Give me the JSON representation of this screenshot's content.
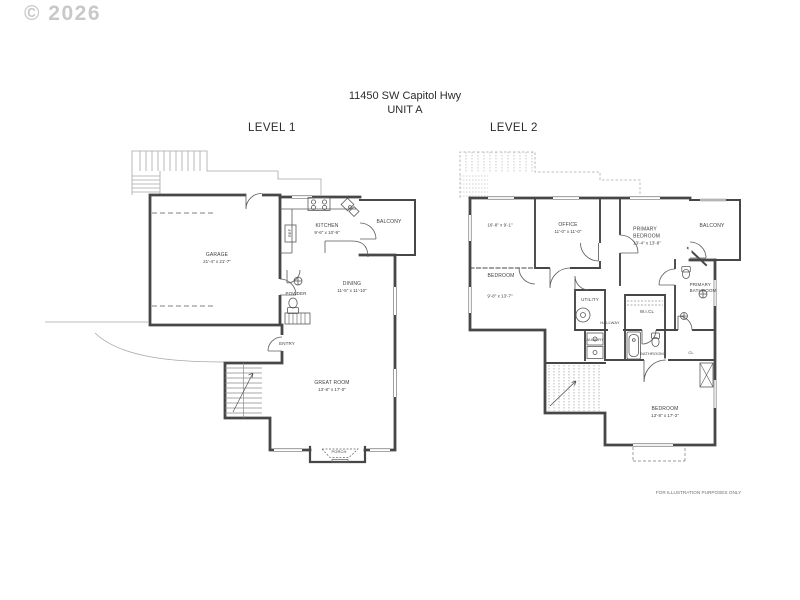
{
  "watermark": "© 2026",
  "title": {
    "address": "11450 SW Capitol Hwy",
    "unit": "UNIT A"
  },
  "footer": {
    "disclaimer": "FOR ILLUSTRATION PURPOSES ONLY"
  },
  "levels": {
    "level1": {
      "heading": "LEVEL 1",
      "rooms": {
        "garage": {
          "name": "GARAGE",
          "dims": "21'-4\" x 21'-7\""
        },
        "kitchen": {
          "name": "KITCHEN",
          "dims": "9'-6\" x 10'-9\""
        },
        "balcony": {
          "name": "BALCONY"
        },
        "dining": {
          "name": "DINING",
          "dims": "11'-5\" x 11'-10\""
        },
        "powder": {
          "name": "POWDER"
        },
        "entry": {
          "name": "ENTRY"
        },
        "great_room": {
          "name": "GREAT ROOM",
          "dims": "13'-8\" x 17'-0\""
        },
        "porch": {
          "name": "PORCH"
        },
        "ref": {
          "name": "REF"
        }
      }
    },
    "level2": {
      "heading": "LEVEL 2",
      "rooms": {
        "open_area": {
          "dims": "16'-8\" x 9'-1\""
        },
        "bedroom2": {
          "name": "BEDROOM",
          "dims": "9'-8\" x 13'-7\""
        },
        "office": {
          "name": "OFFICE",
          "dims": "11'-0\" x 11'-0\""
        },
        "primary_bedroom": {
          "name": "PRIMARY BEDROOM",
          "dims": "13'-4\" x 13'-8\""
        },
        "balcony": {
          "name": "BALCONY"
        },
        "primary_bathroom": {
          "name": "PRIMARY BATHROOM"
        },
        "utility": {
          "name": "UTILITY"
        },
        "walk_in_closet": {
          "name": "W.I.CL"
        },
        "hallway": {
          "name": "HALLWAY"
        },
        "laundry": {
          "name": "LAUNDRY"
        },
        "bathroom": {
          "name": "BATHROOM"
        },
        "closet": {
          "name": "CL"
        },
        "bedroom3": {
          "name": "BEDROOM",
          "dims": "13'-8\" x 17'-2\""
        }
      }
    }
  },
  "colors": {
    "wall": "#474747",
    "thin_line": "#a8a8a8",
    "label_text": "#3f3f3f",
    "watermark": "#c8c8c8"
  }
}
